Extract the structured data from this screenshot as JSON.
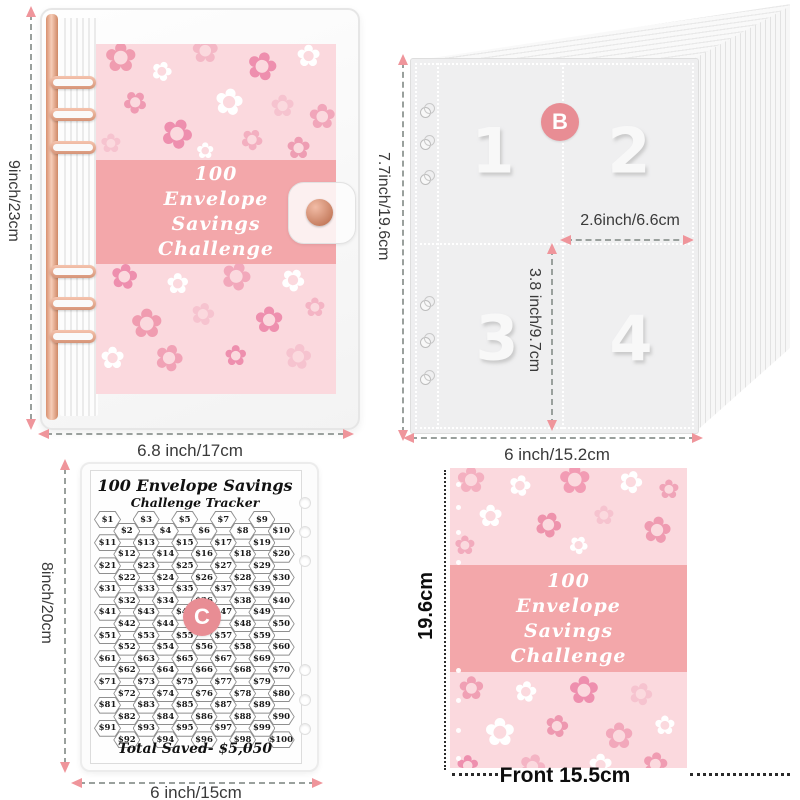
{
  "colors": {
    "badge": "#e88d94",
    "arrow_head": "#ef959b",
    "dash": "#9aa09d",
    "band": "#f3a7aa",
    "cover_bg": "#fbd9de",
    "label": "#3a3a3a"
  },
  "binder": {
    "title_lines": [
      "100",
      "Envelope",
      "Savings",
      "Challenge"
    ],
    "dims": {
      "height": "9inch/23cm",
      "width": "6.8 inch/17cm"
    }
  },
  "sleeves": {
    "badge": "B",
    "pockets": [
      "1",
      "2",
      "3",
      "4"
    ],
    "dims": {
      "height": "7.7inch/19.6cm",
      "pocket_width": "2.6inch/6.6cm",
      "pocket_height": "3.8 inch/9.7cm",
      "width": "6 inch/15.2cm"
    }
  },
  "tracker": {
    "badge": "C",
    "title1": "100 Envelope Savings",
    "title2": "Challenge Tracker",
    "total": "Total Saved- $5,050",
    "dims": {
      "height": "8inch/20cm",
      "width": "6 inch/15cm"
    },
    "rows": [
      [
        "$1",
        "$3",
        "$5",
        "$7",
        "$9"
      ],
      [
        "$2",
        "$4",
        "$6",
        "$8",
        "$10"
      ],
      [
        "$11",
        "$13",
        "$15",
        "$17",
        "$19"
      ],
      [
        "$12",
        "$14",
        "$16",
        "$18",
        "$20"
      ],
      [
        "$21",
        "$23",
        "$25",
        "$27",
        "$29"
      ],
      [
        "$22",
        "$24",
        "$26",
        "$28",
        "$30"
      ],
      [
        "$31",
        "$33",
        "$35",
        "$37",
        "$39"
      ],
      [
        "$32",
        "$34",
        "$36",
        "$38",
        "$40"
      ],
      [
        "$41",
        "$43",
        "$45",
        "$47",
        "$49"
      ],
      [
        "$42",
        "$44",
        "$46",
        "$48",
        "$50"
      ],
      [
        "$51",
        "$53",
        "$55",
        "$57",
        "$59"
      ],
      [
        "$52",
        "$54",
        "$56",
        "$58",
        "$60"
      ],
      [
        "$61",
        "$63",
        "$65",
        "$67",
        "$69"
      ],
      [
        "$62",
        "$64",
        "$66",
        "$68",
        "$70"
      ],
      [
        "$71",
        "$73",
        "$75",
        "$77",
        "$79"
      ],
      [
        "$72",
        "$74",
        "$76",
        "$78",
        "$80"
      ],
      [
        "$81",
        "$83",
        "$85",
        "$87",
        "$89"
      ],
      [
        "$82",
        "$84",
        "$86",
        "$88",
        "$90"
      ],
      [
        "$91",
        "$93",
        "$95",
        "$97",
        "$99"
      ],
      [
        "$92",
        "$94",
        "$96",
        "$98",
        "$100"
      ]
    ]
  },
  "cover": {
    "title_lines": [
      "100",
      "Envelope",
      "Savings",
      "Challenge"
    ],
    "dims": {
      "height": "19.6cm",
      "width": "Front 15.5cm"
    }
  }
}
